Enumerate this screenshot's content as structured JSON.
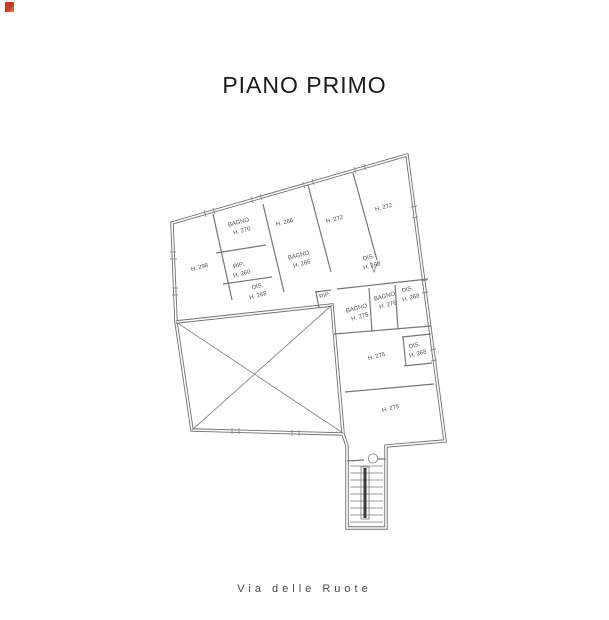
{
  "title": "PIANO PRIMO",
  "street_label": "Via delle Ruote",
  "colors": {
    "wall_line": "#6f6f6f",
    "room_label_text": "#4f4f4f",
    "title_text": "#1a1a1a",
    "scan_mark_red": "#c13a24"
  },
  "rooms": [
    {
      "name": "camera-left",
      "label": "H. 298"
    },
    {
      "name": "bagno-nw",
      "label": "BAGNO",
      "sub": "H. 270"
    },
    {
      "name": "rip-nw",
      "label": "RIP.",
      "sub": "H. 260"
    },
    {
      "name": "dis-nw",
      "label": "DIS.",
      "sub": "H. 268"
    },
    {
      "name": "bagno-center",
      "label": "BAGNO",
      "sub": "H. 266"
    },
    {
      "name": "camera-center",
      "label": "H. 266"
    },
    {
      "name": "camera-272-a",
      "label": "H. 272"
    },
    {
      "name": "camera-272-b",
      "label": "H. 272"
    },
    {
      "name": "dis-center",
      "label": "DIS.",
      "sub": "H. 268"
    },
    {
      "name": "rip-center",
      "label": "RIP."
    },
    {
      "name": "bagno-south-a",
      "label": "BAGNO",
      "sub": "H. 275"
    },
    {
      "name": "bagno-south-b",
      "label": "BAGNO",
      "sub": "H. 276"
    },
    {
      "name": "dis-east-a",
      "label": "DIS.",
      "sub": "H. 268"
    },
    {
      "name": "camera-south-mid",
      "label": "H. 275"
    },
    {
      "name": "dis-east-b",
      "label": "DIS.",
      "sub": "H. 268"
    },
    {
      "name": "camera-south",
      "label": "H. 275"
    }
  ]
}
